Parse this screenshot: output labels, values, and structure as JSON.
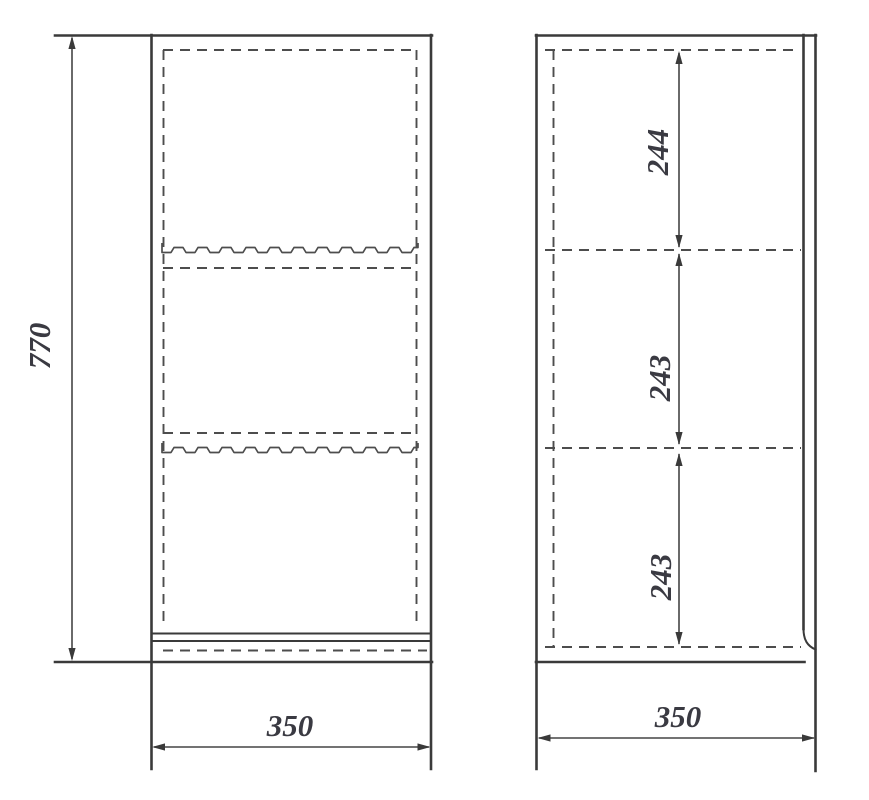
{
  "drawing": {
    "kind": "cabinet-orthographic-drawing",
    "views": {
      "front": {
        "name": "front view"
      },
      "side": {
        "name": "side view"
      }
    },
    "dims": {
      "front_height": "770",
      "front_width": "350",
      "side_depth": "350",
      "side_sections": [
        "244",
        "243",
        "243"
      ]
    },
    "colors": {
      "outline": "#3a3a3a",
      "hidden_line": "#4d4d4d",
      "dimension_line": "#454545",
      "text": "#3a3a42",
      "background": "#ffffff"
    }
  }
}
